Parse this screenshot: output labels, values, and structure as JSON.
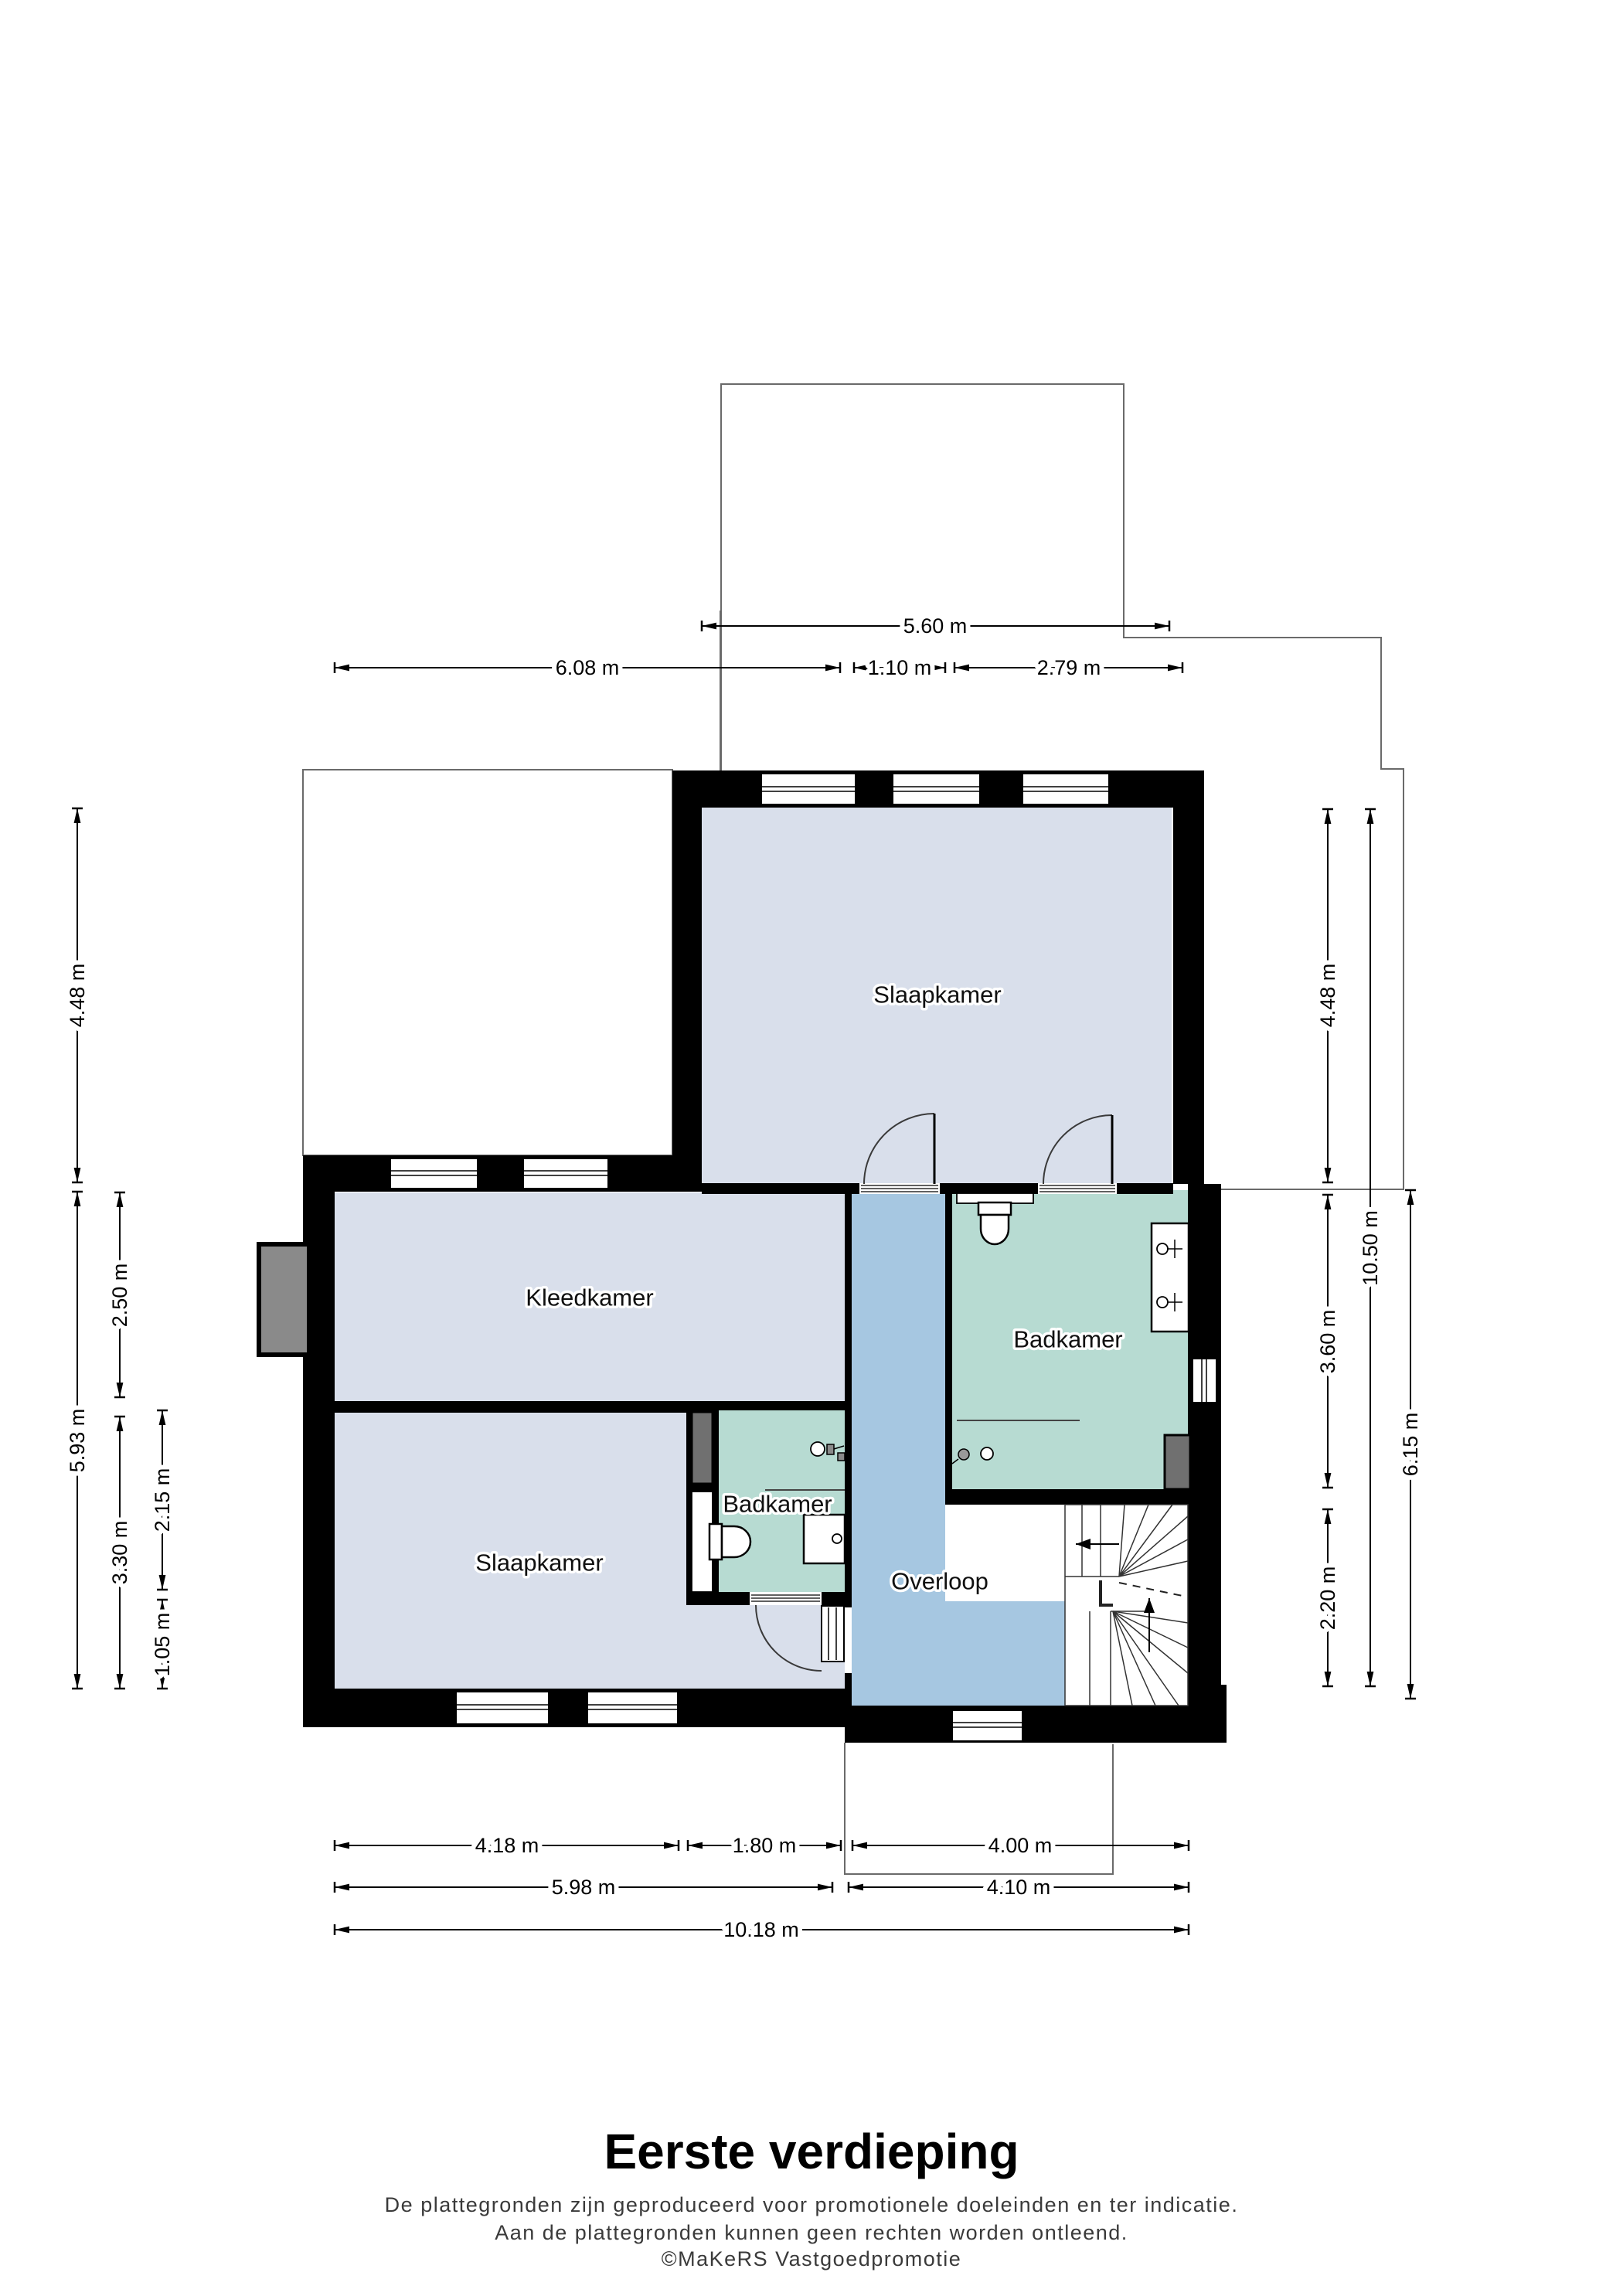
{
  "meta": {
    "title": "Eerste verdieping",
    "disclaimer_line1": "De plattegronden zijn geproduceerd voor promotionele doeleinden en ter indicatie.",
    "disclaimer_line2": "Aan de plattegronden kunnen geen rechten worden ontleend.",
    "credit": "©MaKeRS Vastgoedpromotie"
  },
  "colors": {
    "wall": "#000000",
    "bedroom_fill": "#d9dfeb",
    "bathroom_fill": "#b7dbd2",
    "landing_fill": "#a6c7e1",
    "contour_line": "#6a6a6a",
    "chimney_gray": "#8a8a8a",
    "background": "#ffffff"
  },
  "rooms": [
    {
      "id": "slaapkamer-boven",
      "label": "Slaapkamer"
    },
    {
      "id": "kleedkamer",
      "label": "Kleedkamer"
    },
    {
      "id": "badkamer-groot",
      "label": "Badkamer"
    },
    {
      "id": "badkamer-klein",
      "label": "Badkamer"
    },
    {
      "id": "slaapkamer-onder",
      "label": "Slaapkamer"
    },
    {
      "id": "overloop",
      "label": "Overloop"
    }
  ],
  "dimensions": {
    "top": [
      {
        "label": "5.60 m"
      },
      {
        "label": "6.08 m"
      },
      {
        "label": "1.10 m"
      },
      {
        "label": "2.79 m"
      }
    ],
    "left": [
      {
        "label": "4.48 m"
      },
      {
        "label": "5.93 m"
      },
      {
        "label": "2.50 m"
      },
      {
        "label": "3.30 m"
      },
      {
        "label": "2.15 m"
      },
      {
        "label": "1.05 m"
      }
    ],
    "right": [
      {
        "label": "4.48 m"
      },
      {
        "label": "3.60 m"
      },
      {
        "label": "2.20 m"
      },
      {
        "label": "10.50 m"
      },
      {
        "label": "6.15 m"
      }
    ],
    "bottom": [
      {
        "label": "4.18 m"
      },
      {
        "label": "1.80 m"
      },
      {
        "label": "4.00 m"
      },
      {
        "label": "5.98 m"
      },
      {
        "label": "4.10 m"
      },
      {
        "label": "10.18 m"
      }
    ]
  }
}
